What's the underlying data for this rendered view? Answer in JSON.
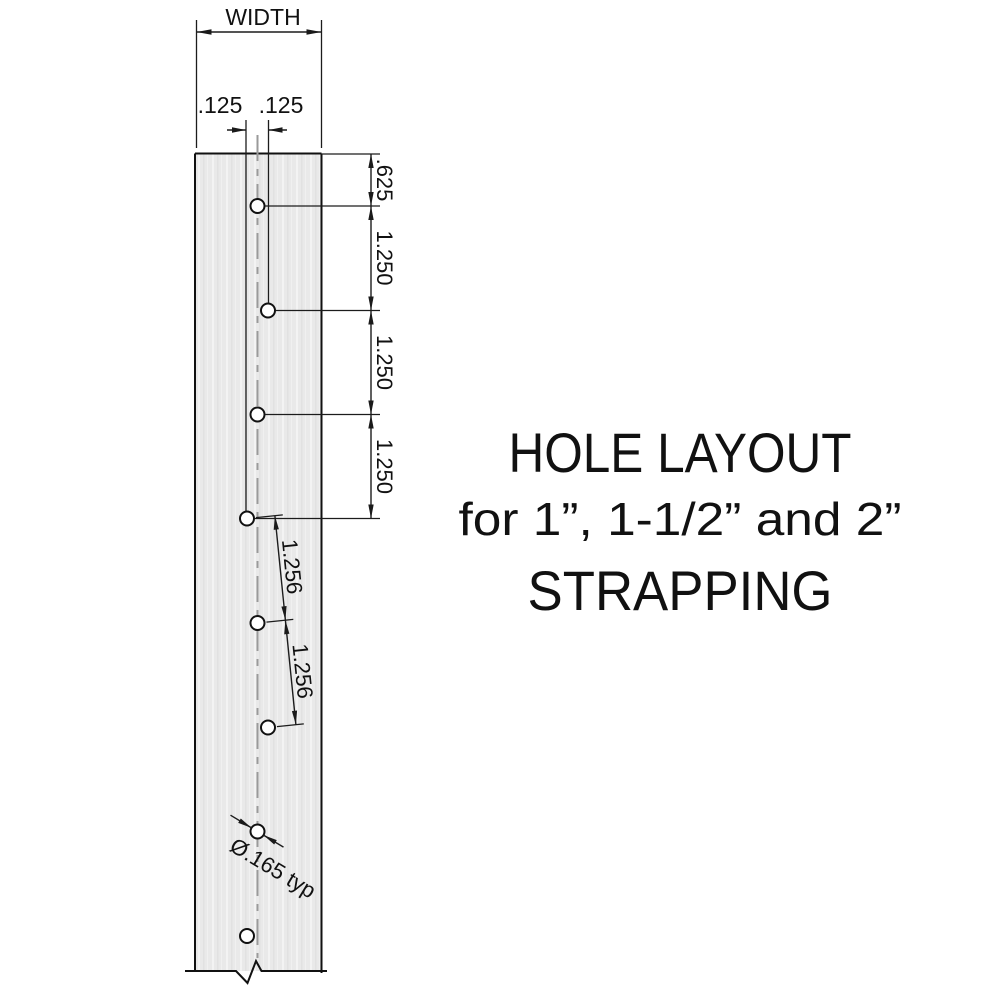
{
  "title": {
    "line1": "HOLE LAYOUT",
    "line2": "for 1”, 1-1/2” and 2”",
    "line3": "STRAPPING"
  },
  "dimensions": {
    "width_label": "WIDTH",
    "hole_offset_left": ".125",
    "hole_offset_right": ".125",
    "edge_to_first_hole": ".625",
    "vertical_spacing": [
      "1.250",
      "1.250",
      "1.250"
    ],
    "diagonal_spacing": [
      "1.256",
      "1.256"
    ],
    "hole_diameter_note": "Ø.165 typ"
  },
  "strap": {
    "holes_count": 8,
    "hole_pattern": "staggered: centerline hole, then ±.125 offset alternating"
  },
  "colors": {
    "background": "#ffffff",
    "strap_fill": "#e9e9e9",
    "line": "#1a1a1a",
    "centerline": "#9a9a9a",
    "text": "#111111"
  }
}
